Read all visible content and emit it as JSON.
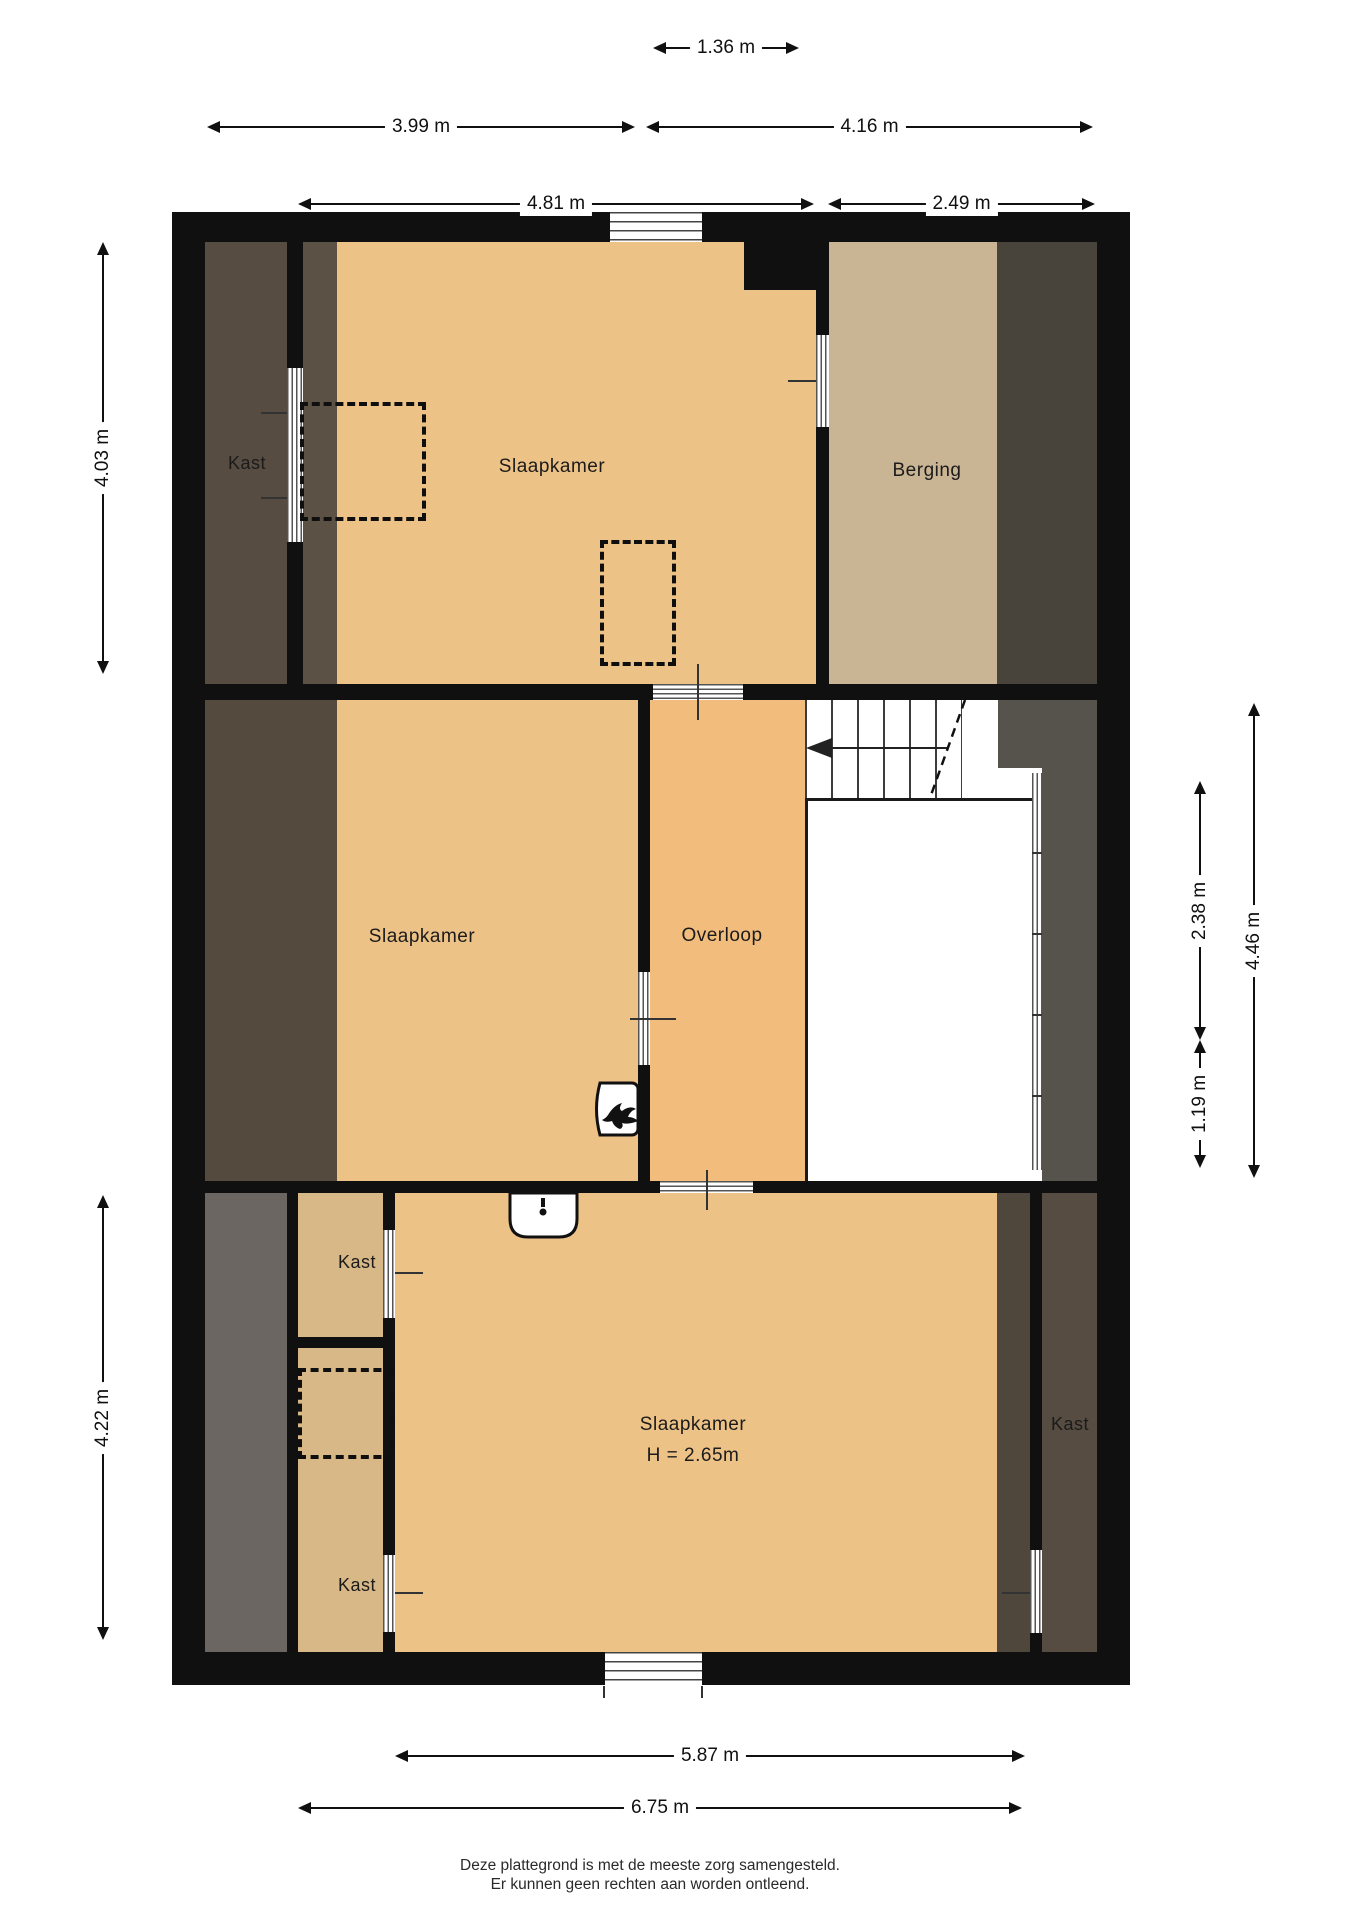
{
  "plan": {
    "type": "floorplan",
    "floor_note": "attic floor with sloped-roof zones (dark bands)",
    "rooms": {
      "kast_top_left": "Kast",
      "slaapkamer_top": "Slaapkamer",
      "berging": "Berging",
      "slaapkamer_middle": "Slaapkamer",
      "overloop": "Overloop",
      "kast_bottom_left_upper": "Kast",
      "kast_bottom_left_lower": "Kast",
      "slaapkamer_bottom": "Slaapkamer",
      "slaapkamer_bottom_height": "H = 2.65m",
      "kast_bottom_right": "Kast"
    },
    "dimensions": {
      "top": [
        {
          "value": "1.36 m"
        },
        {
          "value": "3.99 m"
        },
        {
          "value": "4.16 m"
        },
        {
          "value": "4.81 m"
        },
        {
          "value": "2.49 m"
        }
      ],
      "left": [
        {
          "value": "4.03 m"
        },
        {
          "value": "4.22 m"
        }
      ],
      "right": [
        {
          "value": "2.38 m"
        },
        {
          "value": "1.19 m"
        },
        {
          "value": "4.46 m"
        }
      ],
      "bottom": [
        {
          "value": "5.87 m"
        },
        {
          "value": "6.75 m"
        }
      ]
    },
    "icons": {
      "stairs_arrow": "direction-up arrow on staircase",
      "boiler": "flame symbol (cv-boiler) on bedroom wall",
      "sink": "washbasin with faucet"
    }
  },
  "footer": {
    "line1": "Deze plattegrond is met de meeste zorg samengesteld.",
    "line2": "Er kunnen geen rechten aan worden ontleend."
  },
  "colors": {
    "wall": "#101010",
    "bedroom_floor": "#edc287",
    "overloop_floor": "#f2bd7c",
    "dark_brown_band": "#564c41",
    "berging_floor": "#c9b494",
    "berging_dark_band": "#49443b",
    "stairwell_gray": "#56524c",
    "bottom_left_gray": "#6b6661",
    "closet_light": "#d8b887",
    "paper": "#ffffff"
  }
}
